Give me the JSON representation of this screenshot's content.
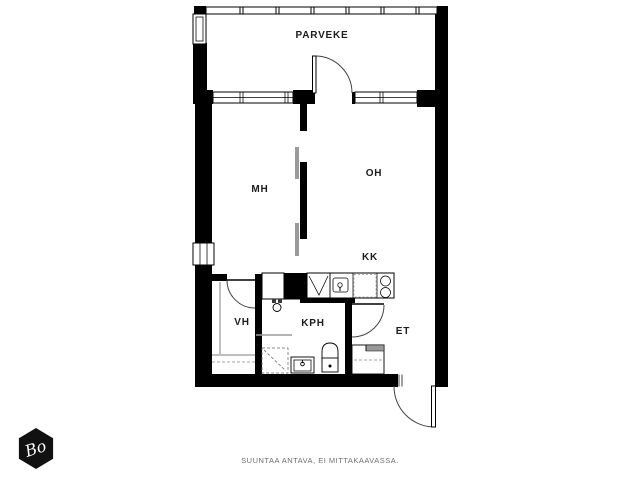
{
  "plan": {
    "rooms": {
      "parveke": {
        "label": "PARVEKE"
      },
      "mh": {
        "label": "MH"
      },
      "oh": {
        "label": "OH"
      },
      "kk": {
        "label": "KK"
      },
      "vh": {
        "label": "VH"
      },
      "kph": {
        "label": "KPH"
      },
      "et": {
        "label": "ET"
      }
    },
    "footer": {
      "disclaimer": "SUUNTAA ANTAVA, EI MITTAKAAVASSA."
    },
    "logo": {
      "text": "Bo"
    },
    "colors": {
      "wall": "#000000",
      "background": "#ffffff",
      "sliding_door": "#9a9a9a",
      "annotation_gray": "#6f6f6f"
    }
  }
}
